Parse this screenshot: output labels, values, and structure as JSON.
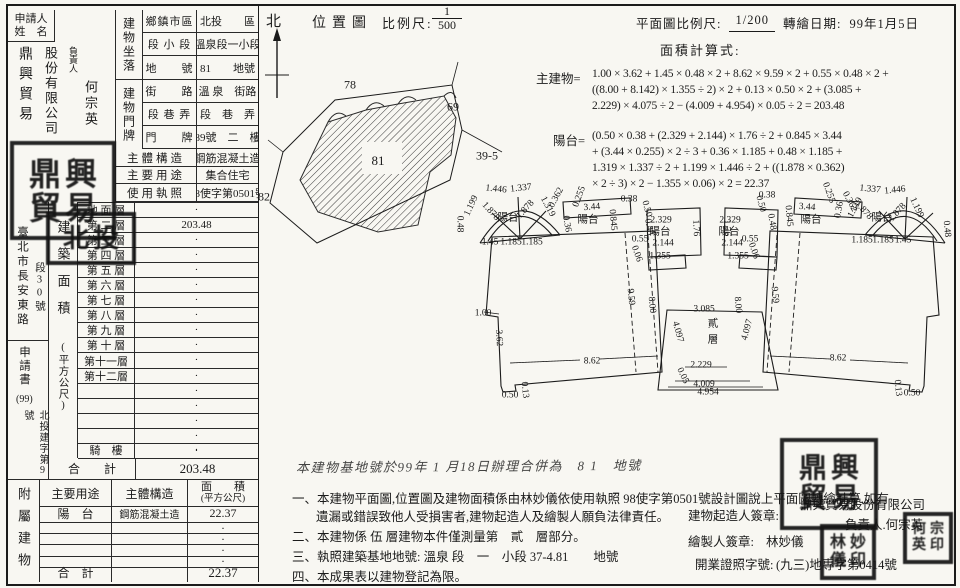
{
  "accent": {
    "ink": "#1b1b1b",
    "paper": "#f8f7f2"
  },
  "left_table": {
    "applicant_label1": "申請人",
    "applicant_label2": "姓　名",
    "name_col1": "鼎興貿易",
    "name_col2": "股份有限公司",
    "rep_label": "負責人",
    "rep_name": "何宗英",
    "loc_label": "建物坐落",
    "door_label": "建物門牌",
    "rows": [
      {
        "sub": "鄉鎮市區",
        "value": "北投　　區",
        "h": 23,
        "wide": false
      },
      {
        "sub": "段 小 段",
        "value": "溫泉段一小段",
        "h": 23,
        "wide": false
      },
      {
        "sub": "地　　號",
        "value": "81　　地號",
        "h": 24,
        "wide": false
      },
      {
        "sub": "街　　路",
        "value": "溫 泉　街路",
        "h": 23,
        "wide": false
      },
      {
        "sub": "段 巷 弄",
        "value": "段　巷　弄",
        "h": 23,
        "wide": false
      },
      {
        "sub": "門　　牌",
        "value": "89號　二　樓",
        "h": 23,
        "wide": false
      },
      {
        "sub": "主體構造",
        "value": "鋼筋混凝土造",
        "h": 18,
        "wide": true
      },
      {
        "sub": "主要用途",
        "value": "集合住宅",
        "h": 17,
        "wide": true
      },
      {
        "sub": "使用執照",
        "value": "98使字第0501號",
        "h": 18,
        "wide": true
      }
    ],
    "margin_top": "臺北市長安東路",
    "margin_top2": "段30號",
    "margin_mid": "申請書",
    "margin_num": "(99)",
    "margin_bottom": "北投建字第9號",
    "area_header": "建築面積",
    "area_unit": "(平方公尺)",
    "floor_rows": [
      {
        "label": "地 面 層",
        "value": "·"
      },
      {
        "label": "第 二 層",
        "value": "203.48"
      },
      {
        "label": "第 三 層",
        "value": "·"
      },
      {
        "label": "第 四 層",
        "value": "·"
      },
      {
        "label": "第 五 層",
        "value": "·"
      },
      {
        "label": "第 六 層",
        "value": "·"
      },
      {
        "label": "第 七 層",
        "value": "·"
      },
      {
        "label": "第 八 層",
        "value": "·"
      },
      {
        "label": "第 九 層",
        "value": "·"
      },
      {
        "label": "第 十 層",
        "value": "·"
      },
      {
        "label": "第十一層",
        "value": "·"
      },
      {
        "label": "第十二層",
        "value": "·"
      },
      {
        "label": "",
        "value": "·"
      },
      {
        "label": "",
        "value": "·"
      },
      {
        "label": "",
        "value": "·"
      },
      {
        "label": "",
        "value": "·"
      },
      {
        "label": "",
        "value": "·"
      }
    ],
    "qilou_label": "騎　樓",
    "qilou_value": "·",
    "total_label": "合　　計",
    "total_value": "203.48"
  },
  "annex": {
    "side_label": "附屬建物",
    "h_use": "主要用途",
    "h_struct": "主體構造",
    "h_area": "面　　積",
    "h_area_unit": "(平方公尺)",
    "rows": [
      {
        "use": "陽　台",
        "structure": "鋼筋混凝土造",
        "area": "22.37"
      },
      {
        "use": "",
        "structure": "",
        "area": "·"
      },
      {
        "use": "",
        "structure": "",
        "area": "·"
      },
      {
        "use": "",
        "structure": "",
        "area": "·"
      },
      {
        "use": "",
        "structure": "",
        "area": "·"
      }
    ],
    "total_label": "合　計",
    "total_value": "22.37"
  },
  "map": {
    "north": "北",
    "title": "位置圖",
    "scale_label": "比例尺:",
    "frac_num": "1",
    "frac_den": "500",
    "labels": [
      {
        "t": "78",
        "x": 350,
        "y": 85,
        "fs": 12
      },
      {
        "t": "69",
        "x": 453,
        "y": 107,
        "fs": 12
      },
      {
        "t": "82",
        "x": 264,
        "y": 197,
        "fs": 12
      },
      {
        "t": "39-5",
        "x": 487,
        "y": 156,
        "fs": 12
      },
      {
        "t": "81",
        "x": 378,
        "y": 161,
        "fs": 13
      }
    ]
  },
  "plan": {
    "scale_label": "平面圖比例尺:",
    "scale_value": "1/200",
    "date_label": "轉繪日期:",
    "date_value": "99年1月5日",
    "calc_label": "面積計算式:",
    "main_label": "主建物=",
    "main_lines": [
      "1.00 × 3.62 + 1.45 × 0.48 × 2 + 8.62 × 9.59 × 2 + 0.55 × 0.48 × 2 +",
      "((8.00 + 8.142) × 1.355 ÷ 2) × 2 + 0.13 × 0.50 × 2 + (3.085 +",
      "2.229) × 4.075 ÷ 2 − (4.009 + 4.954) × 0.05 ÷ 2 = 203.48"
    ],
    "balc_label": "陽台=",
    "balc_lines": [
      "(0.50 × 0.38 + (2.329 + 2.144) × 1.76 ÷ 2 + 0.845 × 3.44",
      "+ (3.44 × 0.255) × 2 ÷ 3 + 0.36 × 1.185 + 0.48 × 1.185 +",
      "1.319 × 1.337 ÷ 2 + 1.199 × 1.446 ÷ 2 + ((1.878 × 0.362)",
      "× 2 ÷ 3) × 2  − 1.355 × 0.06) × 2 = 22.37"
    ],
    "dims": [
      {
        "t": "0.48",
        "x": 459,
        "y": 224,
        "r": 90
      },
      {
        "t": "1.199",
        "x": 472,
        "y": 206,
        "r": -65
      },
      {
        "t": "1.446",
        "x": 496,
        "y": 190,
        "r": 6
      },
      {
        "t": "1.337",
        "x": 521,
        "y": 189,
        "r": -6
      },
      {
        "t": "1.878",
        "x": 490,
        "y": 212,
        "r": 48
      },
      {
        "t": "陽台",
        "x": 508,
        "y": 218,
        "r": 0,
        "cjk": true
      },
      {
        "t": "1.878",
        "x": 526,
        "y": 210,
        "r": -48
      },
      {
        "t": "1.319",
        "x": 547,
        "y": 207,
        "r": 62
      },
      {
        "t": "0.362",
        "x": 557,
        "y": 198,
        "r": -62
      },
      {
        "t": "0.255",
        "x": 580,
        "y": 197,
        "r": -70
      },
      {
        "t": "1.45",
        "x": 490,
        "y": 243,
        "r": 0
      },
      {
        "t": "1.185",
        "x": 511,
        "y": 243,
        "r": 0
      },
      {
        "t": "1.185",
        "x": 532,
        "y": 243,
        "r": 0
      },
      {
        "t": "0.36",
        "x": 566,
        "y": 224,
        "r": 80
      },
      {
        "t": "3.44",
        "x": 592,
        "y": 208,
        "r": -4
      },
      {
        "t": "陽台",
        "x": 588,
        "y": 220,
        "r": 0,
        "cjk": true
      },
      {
        "t": "0.845",
        "x": 612,
        "y": 220,
        "r": 85
      },
      {
        "t": "0.38",
        "x": 629,
        "y": 200,
        "r": 0
      },
      {
        "t": "0.50",
        "x": 646,
        "y": 209,
        "r": 75
      },
      {
        "t": "0.48",
        "x": 648,
        "y": 227,
        "r": 80
      },
      {
        "t": "0.55",
        "x": 640,
        "y": 240,
        "r": 0
      },
      {
        "t": "2.329",
        "x": 661,
        "y": 221,
        "r": 0
      },
      {
        "t": "陽台",
        "x": 660,
        "y": 232,
        "r": 0,
        "cjk": true
      },
      {
        "t": "2.144",
        "x": 663,
        "y": 244,
        "r": 0
      },
      {
        "t": "1.355",
        "x": 660,
        "y": 257,
        "r": 0
      },
      {
        "t": "0.06",
        "x": 636,
        "y": 254,
        "r": 70
      },
      {
        "t": "1.76",
        "x": 695,
        "y": 228,
        "r": 87
      },
      {
        "t": "1.76",
        "x": 726,
        "y": 228,
        "r": 87
      },
      {
        "t": "2.329",
        "x": 730,
        "y": 221,
        "r": 0
      },
      {
        "t": "陽台",
        "x": 729,
        "y": 232,
        "r": 0,
        "cjk": true
      },
      {
        "t": "2.144",
        "x": 732,
        "y": 244,
        "r": 0
      },
      {
        "t": "1.355",
        "x": 738,
        "y": 257,
        "r": 0
      },
      {
        "t": "0.55",
        "x": 750,
        "y": 240,
        "r": 0
      },
      {
        "t": "0.48",
        "x": 771,
        "y": 222,
        "r": 80
      },
      {
        "t": "0.50",
        "x": 760,
        "y": 204,
        "r": 75
      },
      {
        "t": "0.38",
        "x": 767,
        "y": 196,
        "r": 0
      },
      {
        "t": "0.06",
        "x": 753,
        "y": 251,
        "r": 70
      },
      {
        "t": "0.845",
        "x": 788,
        "y": 216,
        "r": 85
      },
      {
        "t": "3.44",
        "x": 807,
        "y": 208,
        "r": 4
      },
      {
        "t": "陽台",
        "x": 811,
        "y": 220,
        "r": 0,
        "cjk": true
      },
      {
        "t": "0.255",
        "x": 828,
        "y": 193,
        "r": 70
      },
      {
        "t": "0.36",
        "x": 840,
        "y": 210,
        "r": -80
      },
      {
        "t": "0.362",
        "x": 849,
        "y": 202,
        "r": 62
      },
      {
        "t": "1.319",
        "x": 856,
        "y": 208,
        "r": -62
      },
      {
        "t": "1.337",
        "x": 870,
        "y": 190,
        "r": 6
      },
      {
        "t": "1.446",
        "x": 895,
        "y": 191,
        "r": -6
      },
      {
        "t": "1.878",
        "x": 863,
        "y": 211,
        "r": 48
      },
      {
        "t": "陽台",
        "x": 882,
        "y": 218,
        "r": 0,
        "cjk": true
      },
      {
        "t": "1.878",
        "x": 898,
        "y": 213,
        "r": -48
      },
      {
        "t": "1.199",
        "x": 916,
        "y": 208,
        "r": 65
      },
      {
        "t": "0.48",
        "x": 946,
        "y": 229,
        "r": 85
      },
      {
        "t": "1.185",
        "x": 862,
        "y": 241,
        "r": 0
      },
      {
        "t": "1.185",
        "x": 883,
        "y": 241,
        "r": 0
      },
      {
        "t": "1.45",
        "x": 903,
        "y": 241,
        "r": 0
      },
      {
        "t": "9.59",
        "x": 630,
        "y": 297,
        "r": 85
      },
      {
        "t": "8.00",
        "x": 651,
        "y": 305,
        "r": 85
      },
      {
        "t": "8.00",
        "x": 737,
        "y": 305,
        "r": 85
      },
      {
        "t": "9.59",
        "x": 774,
        "y": 295,
        "r": 85
      },
      {
        "t": "4.097",
        "x": 677,
        "y": 332,
        "r": 75
      },
      {
        "t": "4.097",
        "x": 748,
        "y": 330,
        "r": -75
      },
      {
        "t": "3.085",
        "x": 704,
        "y": 310,
        "r": 0
      },
      {
        "t": "貳",
        "x": 713,
        "y": 324,
        "r": 0,
        "cjk": true
      },
      {
        "t": "層",
        "x": 713,
        "y": 340,
        "r": 0,
        "cjk": true
      },
      {
        "t": "1.00",
        "x": 483,
        "y": 314,
        "r": 0
      },
      {
        "t": "3.62",
        "x": 498,
        "y": 338,
        "r": 87
      },
      {
        "t": "8.62",
        "x": 592,
        "y": 362,
        "r": 0
      },
      {
        "t": "0.50",
        "x": 510,
        "y": 396,
        "r": 0
      },
      {
        "t": "0.13",
        "x": 524,
        "y": 390,
        "r": 85
      },
      {
        "t": "8.62",
        "x": 838,
        "y": 359,
        "r": 0
      },
      {
        "t": "0.13",
        "x": 897,
        "y": 388,
        "r": 85
      },
      {
        "t": "0.50",
        "x": 912,
        "y": 394,
        "r": 0
      },
      {
        "t": "2.229",
        "x": 701,
        "y": 366,
        "r": 0
      },
      {
        "t": "0.05",
        "x": 682,
        "y": 376,
        "r": 65
      },
      {
        "t": "4.009",
        "x": 704,
        "y": 385,
        "r": 0
      },
      {
        "t": "4.954",
        "x": 708,
        "y": 393,
        "r": 0
      }
    ]
  },
  "notes": {
    "handwritten": "本建物基地號於99年 1 月18日辦理合併為　8 1　地號",
    "items": [
      {
        "t": "一、本建物平面圖,位置圖及建物面積係由林妙儀依使用執照 98使字第0501號設計圖說上平面圖轉繪計算,如有",
        "x": 292,
        "y": 488
      },
      {
        "t": "遺漏或錯誤致他人受損害者,建物起造人及繪製人願負法律責任。",
        "x": 316,
        "y": 506
      },
      {
        "t": "二、本建物係 伍 層建物本件僅測量第　貳　層部分。",
        "x": 292,
        "y": 526
      },
      {
        "t": "三、執照建築基地地號: 溫泉 段　一　小段 37-4.81　　地號",
        "x": 292,
        "y": 546
      },
      {
        "t": "四、本成果表以建物登記為限。",
        "x": 292,
        "y": 566
      }
    ],
    "sig1_label": "建物起造人簽章:",
    "sig1_value1": "鼎興貿易股份有限公司",
    "sig1_value2": "負責人.何宗英",
    "sig2_label": "繪製人簽章:",
    "sig2_value": "林妙儀",
    "sig3_label": "開業證照字號:",
    "sig3_value": "(九三)地專字第0414號"
  },
  "seals": [
    {
      "x": 10,
      "y": 141,
      "w": 100,
      "h": 93,
      "chars": "鼎興貿易",
      "cols": 2,
      "fs": 32
    },
    {
      "x": 46,
      "y": 212,
      "w": 84,
      "h": 47,
      "chars": "北投",
      "cols": 2,
      "fs": 26
    },
    {
      "x": 780,
      "y": 438,
      "w": 92,
      "h": 86,
      "chars": "鼎興貿易",
      "cols": 2,
      "fs": 28
    },
    {
      "x": 820,
      "y": 524,
      "w": 50,
      "h": 50,
      "chars": "林妙儀印",
      "cols": 2,
      "fs": 16
    },
    {
      "x": 903,
      "y": 512,
      "w": 44,
      "h": 46,
      "chars": "何宗英印",
      "cols": 2,
      "fs": 14
    }
  ]
}
